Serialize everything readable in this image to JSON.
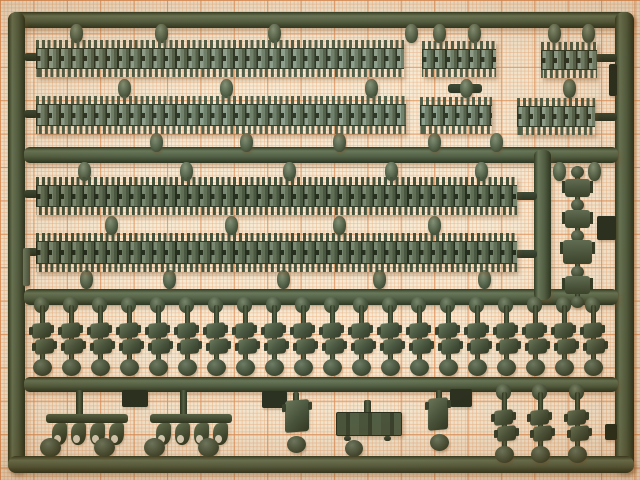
{
  "meta": {
    "description": "Photograph of a dark olive-green injection-molded model kit sprue holding tank track links, lying on orange graph paper"
  },
  "scene": {
    "palette": {
      "paper": "#f5e9d2",
      "grid_major": "#de8a4e",
      "grid_minor": "#ecb282",
      "plastic_base": "#3e4b33",
      "plastic_dark": "#1c2513",
      "plastic_highlight": "#6d7d60",
      "track_light": "#879a86",
      "track_mid": "#667861"
    },
    "frame": {
      "runners": [
        {
          "d": "h",
          "x": 8,
          "y": 12,
          "w": 626,
          "h": 16,
          "r": 8
        },
        {
          "d": "v",
          "x": 8,
          "y": 12,
          "w": 17,
          "h": 461,
          "r": 8
        },
        {
          "d": "v",
          "x": 615,
          "y": 12,
          "w": 19,
          "h": 461,
          "r": 8
        },
        {
          "d": "h",
          "x": 8,
          "y": 456,
          "w": 626,
          "h": 17,
          "r": 8
        },
        {
          "d": "h",
          "x": 24,
          "y": 147,
          "w": 594,
          "h": 16,
          "r": 6
        },
        {
          "d": "h",
          "x": 24,
          "y": 289,
          "w": 594,
          "h": 16,
          "r": 6
        },
        {
          "d": "h",
          "x": 24,
          "y": 377,
          "w": 594,
          "h": 15,
          "r": 6
        },
        {
          "d": "v",
          "x": 534,
          "y": 150,
          "w": 17,
          "h": 150,
          "r": 6
        }
      ],
      "stubs": [
        {
          "x": 24,
          "y": 53,
          "w": 14,
          "h": 8
        },
        {
          "x": 24,
          "y": 110,
          "w": 14,
          "h": 8
        },
        {
          "x": 24,
          "y": 190,
          "w": 14,
          "h": 8
        },
        {
          "x": 24,
          "y": 248,
          "w": 14,
          "h": 8
        },
        {
          "x": 515,
          "y": 192,
          "w": 22,
          "h": 8
        },
        {
          "x": 515,
          "y": 250,
          "w": 22,
          "h": 8
        },
        {
          "x": 595,
          "y": 54,
          "w": 22,
          "h": 8
        },
        {
          "x": 593,
          "y": 113,
          "w": 24,
          "h": 8
        },
        {
          "x": 448,
          "y": 84,
          "w": 34,
          "h": 9
        }
      ],
      "tabs": [
        {
          "x": 23,
          "y": 248,
          "w": 7,
          "h": 38,
          "light": true
        },
        {
          "x": 609,
          "y": 64,
          "w": 8,
          "h": 32
        },
        {
          "x": 597,
          "y": 216,
          "w": 19,
          "h": 24
        },
        {
          "x": 605,
          "y": 424,
          "w": 12,
          "h": 16
        },
        {
          "x": 122,
          "y": 390,
          "w": 26,
          "h": 17
        },
        {
          "x": 262,
          "y": 391,
          "w": 25,
          "h": 17
        },
        {
          "x": 450,
          "y": 389,
          "w": 22,
          "h": 18
        }
      ]
    },
    "tracks": [
      {
        "x": 36,
        "y": 40,
        "w": 368,
        "h": 37,
        "tone": "a"
      },
      {
        "x": 422,
        "y": 41,
        "w": 74,
        "h": 36,
        "tone": "a"
      },
      {
        "x": 541,
        "y": 42,
        "w": 56,
        "h": 36,
        "tone": "a"
      },
      {
        "x": 36,
        "y": 96,
        "w": 370,
        "h": 38,
        "tone": "a"
      },
      {
        "x": 420,
        "y": 97,
        "w": 72,
        "h": 37,
        "tone": "a"
      },
      {
        "x": 517,
        "y": 98,
        "w": 78,
        "h": 37,
        "tone": "a"
      },
      {
        "x": 36,
        "y": 177,
        "w": 481,
        "h": 38,
        "tone": "b"
      },
      {
        "x": 36,
        "y": 233,
        "w": 481,
        "h": 39,
        "tone": "b"
      }
    ],
    "peg_rows": [
      {
        "y": 24,
        "xs": [
          70,
          155,
          268,
          405,
          433,
          468,
          548,
          582
        ]
      },
      {
        "y": 79,
        "xs": [
          118,
          220,
          365,
          460,
          563
        ]
      },
      {
        "y": 133,
        "xs": [
          150,
          240,
          333,
          428,
          490
        ]
      },
      {
        "y": 162,
        "xs": [
          78,
          180,
          283,
          385,
          475,
          553,
          588
        ]
      },
      {
        "y": 216,
        "xs": [
          105,
          225,
          333,
          428
        ]
      },
      {
        "y": 270,
        "xs": [
          80,
          163,
          277,
          373,
          478
        ]
      }
    ],
    "peg_size": {
      "w": 13,
      "h": 19
    },
    "units_row": {
      "count": 20,
      "start_x": 30,
      "spacing": 29,
      "y": 297
    },
    "bottom_units": [
      {
        "x": 492,
        "y": 384
      },
      {
        "x": 528,
        "y": 384
      },
      {
        "x": 565,
        "y": 384
      }
    ],
    "clusters": {
      "xs": [
        46,
        150
      ],
      "y": 390,
      "hooks_per_cluster": 4
    },
    "single_parts": [
      {
        "kind": "linkpart",
        "x": 283,
        "y": 392
      },
      {
        "kind": "plate",
        "x": 336,
        "y": 400
      },
      {
        "kind": "linkpart-small",
        "x": 426,
        "y": 390
      }
    ],
    "right_chain": {
      "x": 562,
      "y": 166,
      "items": [
        [
          "disc",
          0
        ],
        [
          "link",
          13
        ],
        [
          "disc",
          33
        ],
        [
          "link",
          44
        ],
        [
          "disc",
          64
        ],
        [
          "wide",
          74
        ],
        [
          "disc",
          100
        ],
        [
          "link",
          110
        ],
        [
          "disc",
          130
        ]
      ]
    }
  }
}
